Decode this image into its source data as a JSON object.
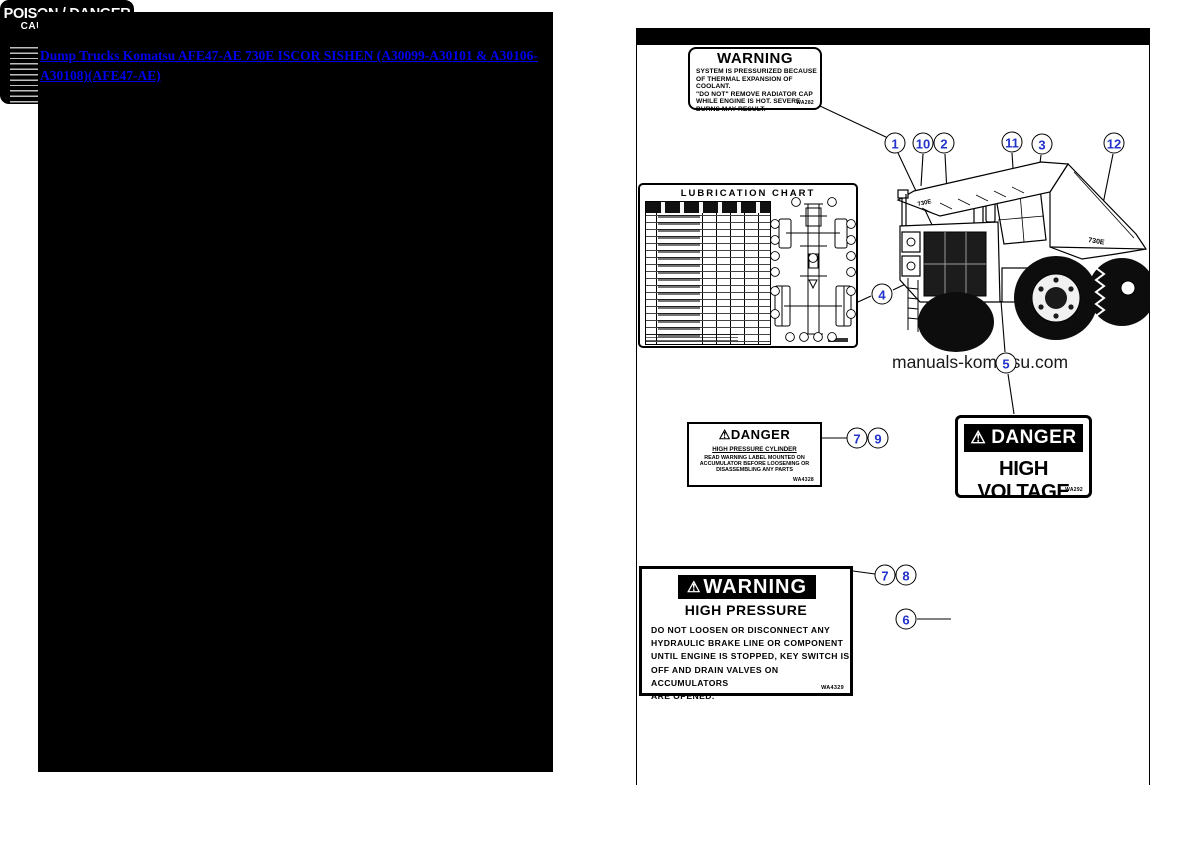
{
  "left_panel": {
    "link_text": "Dump Trucks Komatsu AFE47-AE 730E ISCOR SISHEN (A30099-A30101 & A30106-A30108)(AFE47-AE)"
  },
  "watermark": "manuals-komatsu.com",
  "truck": {
    "model_marking": "730E"
  },
  "chart": {
    "title": "LUBRICATION  CHART"
  },
  "labels": {
    "radiator_warning": {
      "title": "WARNING",
      "lines": [
        "SYSTEM IS PRESSURIZED BECAUSE",
        "OF THERMAL EXPANSION OF COOLANT.",
        "\"DO NOT\" REMOVE RADIATOR CAP",
        "WHILE ENGINE IS HOT. SEVERE",
        "BURNS MAY RESULT."
      ],
      "code": "WA282"
    },
    "hp_cylinder_danger": {
      "warning_icon": "⚠",
      "title": "DANGER",
      "subtitle": "HIGH PRESSURE CYLINDER",
      "lines": [
        "READ WARNING LABEL MOUNTED ON",
        "ACCUMULATOR BEFORE LOOSENING OR",
        "DISASSEMBLING ANY PARTS"
      ],
      "code": "WA4328"
    },
    "high_voltage": {
      "warning_icon": "⚠",
      "title": "DANGER",
      "subtitle": "HIGH VOLTAGE",
      "code": "WA292"
    },
    "high_pressure_warning": {
      "warning_icon": "⚠",
      "title": "WARNING",
      "subtitle": "HIGH PRESSURE",
      "lines": [
        "DO NOT LOOSEN OR DISCONNECT ANY",
        "HYDRAULIC BRAKE LINE OR COMPONENT",
        "UNTIL ENGINE IS STOPPED, KEY SWITCH IS",
        "OFF AND DRAIN VALVES ON ACCUMULATORS",
        "ARE OPENED."
      ],
      "code": "WA4329"
    },
    "poison_danger": {
      "title": "POISON / DANGER",
      "subtitle": "CAUSES SEVERE BURNS"
    }
  },
  "callouts": {
    "c1": "1",
    "c2": "10",
    "c3": "2",
    "c4": "11",
    "c5": "3",
    "c6": "12",
    "c7": "4",
    "c8": "5",
    "c9": "7",
    "c10": "9",
    "c11": "7",
    "c12": "8",
    "c13": "6"
  }
}
